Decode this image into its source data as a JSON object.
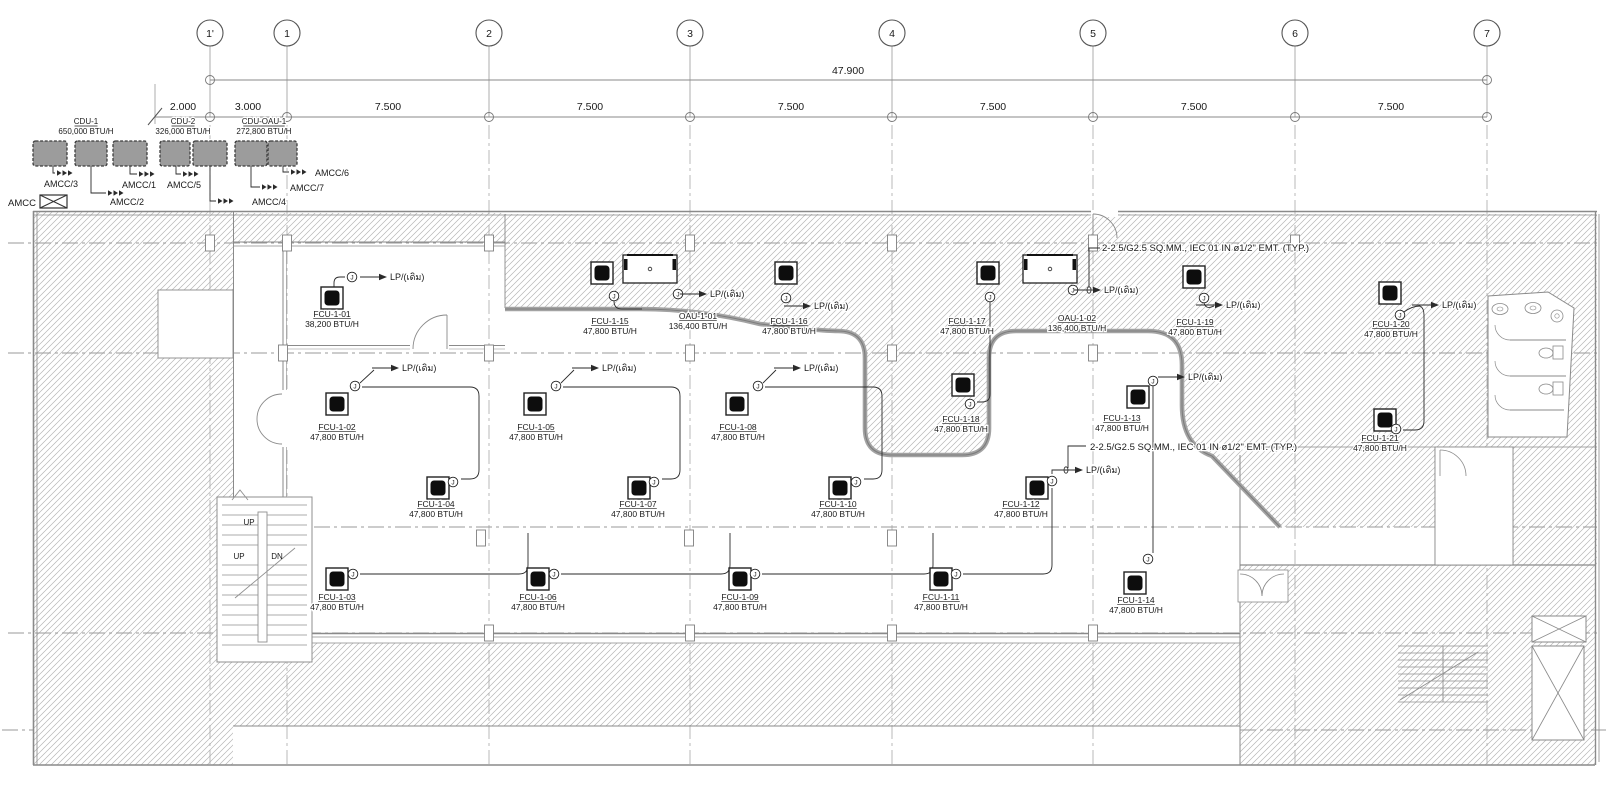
{
  "drawing_title": "FCU electrical floor plan",
  "grid": {
    "columns": [
      {
        "label": "1'",
        "x": 210
      },
      {
        "label": "1",
        "x": 287
      },
      {
        "label": "2",
        "x": 489
      },
      {
        "label": "3",
        "x": 690
      },
      {
        "label": "4",
        "x": 892
      },
      {
        "label": "5",
        "x": 1093
      },
      {
        "label": "6",
        "x": 1295
      },
      {
        "label": "7",
        "x": 1487
      }
    ],
    "overall_dim": {
      "label": "47.900",
      "x": 848,
      "y": 74
    },
    "spacing_dims": [
      {
        "label": "2.000",
        "x": 183
      },
      {
        "label": "3.000",
        "x": 248
      },
      {
        "label": "7.500",
        "x": 388
      },
      {
        "label": "7.500",
        "x": 590
      },
      {
        "label": "7.500",
        "x": 791
      },
      {
        "label": "7.500",
        "x": 993
      },
      {
        "label": "7.500",
        "x": 1194
      },
      {
        "label": "7.500",
        "x": 1391
      }
    ]
  },
  "cdu_bank": {
    "labels": [
      {
        "id": "CDU-1",
        "btu": "650,000 BTU/H",
        "x": 86
      },
      {
        "id": "CDU-2",
        "btu": "326,000 BTU/H",
        "x": 183
      },
      {
        "id": "CDU-OAU-1",
        "btu": "272,800 BTU/H",
        "x": 264
      }
    ],
    "boxes": [
      {
        "x": 33,
        "w": 34
      },
      {
        "x": 75,
        "w": 32
      },
      {
        "x": 113,
        "w": 34
      },
      {
        "x": 160,
        "w": 30
      },
      {
        "x": 193,
        "w": 34
      },
      {
        "x": 235,
        "w": 32
      },
      {
        "x": 268,
        "w": 29
      }
    ],
    "feeders": [
      {
        "label": "AMCC/3",
        "tx": 44,
        "ty": 187,
        "ax": 57,
        "ay": 173,
        "stub": "M53,166 V173 H55"
      },
      {
        "label": "AMCC/2",
        "tx": 110,
        "ty": 205,
        "ax": 108,
        "ay": 193,
        "stub": "M91,166 V193 H106"
      },
      {
        "label": "AMCC/1",
        "tx": 122,
        "ty": 188,
        "ax": 139,
        "ay": 174,
        "stub": "M130,166 V174 H137"
      },
      {
        "label": "AMCC/5",
        "tx": 167,
        "ty": 188,
        "ax": 183,
        "ay": 174,
        "stub": "M176,166 V174 H181"
      },
      {
        "label": "AMCC/4",
        "tx": 252,
        "ty": 205,
        "ax": 218,
        "ay": 201,
        "stub": "M210,166 V201 H216"
      },
      {
        "label": "AMCC/7",
        "tx": 290,
        "ty": 191,
        "ax": 262,
        "ay": 187,
        "stub": "M251,166 V187 H260"
      },
      {
        "label": "AMCC/6",
        "tx": 315,
        "ty": 176,
        "ax": 291,
        "ay": 172,
        "stub": "M283,166 V172 H289"
      }
    ],
    "legend": {
      "label": "AMCC",
      "tx": 8,
      "ty": 206,
      "bx": 40,
      "by": 195,
      "bw": 27,
      "bh": 13
    }
  },
  "units": [
    {
      "id": "FCU-1-01",
      "btu": "38,200 BTU/H",
      "type": "fcu",
      "sx": 332,
      "sy": 298,
      "lx": 332,
      "ly": 317
    },
    {
      "id": "FCU-1-15",
      "btu": "47,800 BTU/H",
      "type": "fcu",
      "sx": 602,
      "sy": 273,
      "lx": 610,
      "ly": 324
    },
    {
      "id": "OAU-1-01",
      "btu": "136,400 BTU/H",
      "type": "oau",
      "sx": 650,
      "sy": 269,
      "lx": 698,
      "ly": 319
    },
    {
      "id": "FCU-1-16",
      "btu": "47,800 BTU/H",
      "type": "fcu",
      "sx": 786,
      "sy": 273,
      "lx": 789,
      "ly": 324
    },
    {
      "id": "FCU-1-17",
      "btu": "47,800 BTU/H",
      "type": "fcu",
      "sx": 988,
      "sy": 273,
      "lx": 967,
      "ly": 324
    },
    {
      "id": "OAU-1-02",
      "btu": "136,400 BTU/H",
      "type": "oau",
      "sx": 1050,
      "sy": 269,
      "lx": 1077,
      "ly": 321
    },
    {
      "id": "FCU-1-19",
      "btu": "47,800 BTU/H",
      "type": "fcu",
      "sx": 1194,
      "sy": 277,
      "lx": 1195,
      "ly": 325
    },
    {
      "id": "FCU-1-20",
      "btu": "47,800 BTU/H",
      "type": "fcu",
      "sx": 1390,
      "sy": 293,
      "lx": 1391,
      "ly": 327
    },
    {
      "id": "FCU-1-02",
      "btu": "47,800 BTU/H",
      "type": "fcu",
      "sx": 337,
      "sy": 404,
      "lx": 337,
      "ly": 430
    },
    {
      "id": "FCU-1-05",
      "btu": "47,800 BTU/H",
      "type": "fcu",
      "sx": 535,
      "sy": 404,
      "lx": 536,
      "ly": 430
    },
    {
      "id": "FCU-1-08",
      "btu": "47,800 BTU/H",
      "type": "fcu",
      "sx": 737,
      "sy": 404,
      "lx": 738,
      "ly": 430
    },
    {
      "id": "FCU-1-18",
      "btu": "47,800 BTU/H",
      "type": "fcu",
      "sx": 963,
      "sy": 385,
      "lx": 961,
      "ly": 422
    },
    {
      "id": "FCU-1-13",
      "btu": "47,800 BTU/H",
      "type": "fcu",
      "sx": 1138,
      "sy": 397,
      "lx": 1122,
      "ly": 421
    },
    {
      "id": "FCU-1-21",
      "btu": "47,800 BTU/H",
      "type": "fcu",
      "sx": 1385,
      "sy": 420,
      "lx": 1380,
      "ly": 441
    },
    {
      "id": "FCU-1-04",
      "btu": "47,800 BTU/H",
      "type": "fcu",
      "sx": 438,
      "sy": 488,
      "lx": 436,
      "ly": 507
    },
    {
      "id": "FCU-1-07",
      "btu": "47,800 BTU/H",
      "type": "fcu",
      "sx": 639,
      "sy": 488,
      "lx": 638,
      "ly": 507
    },
    {
      "id": "FCU-1-10",
      "btu": "47,800 BTU/H",
      "type": "fcu",
      "sx": 840,
      "sy": 488,
      "lx": 838,
      "ly": 507
    },
    {
      "id": "FCU-1-12",
      "btu": "47,800 BTU/H",
      "type": "fcu",
      "sx": 1037,
      "sy": 488,
      "lx": 1021,
      "ly": 507
    },
    {
      "id": "FCU-1-03",
      "btu": "47,800 BTU/H",
      "type": "fcu",
      "sx": 337,
      "sy": 579,
      "lx": 337,
      "ly": 600
    },
    {
      "id": "FCU-1-06",
      "btu": "47,800 BTU/H",
      "type": "fcu",
      "sx": 538,
      "sy": 579,
      "lx": 538,
      "ly": 600
    },
    {
      "id": "FCU-1-09",
      "btu": "47,800 BTU/H",
      "type": "fcu",
      "sx": 740,
      "sy": 579,
      "lx": 740,
      "ly": 600
    },
    {
      "id": "FCU-1-11",
      "btu": "47,800 BTU/H",
      "type": "fcu",
      "sx": 941,
      "sy": 579,
      "lx": 941,
      "ly": 600
    },
    {
      "id": "FCU-1-14",
      "btu": "47,800 BTU/H",
      "type": "fcu",
      "sx": 1135,
      "sy": 583,
      "lx": 1136,
      "ly": 603
    }
  ],
  "junction_boxes": {
    "glyph": "J",
    "points": [
      {
        "x": 352,
        "y": 277
      },
      {
        "x": 614,
        "y": 296
      },
      {
        "x": 678,
        "y": 294
      },
      {
        "x": 786,
        "y": 298
      },
      {
        "x": 990,
        "y": 297
      },
      {
        "x": 1073,
        "y": 290
      },
      {
        "x": 1204,
        "y": 298
      },
      {
        "x": 1400,
        "y": 315
      },
      {
        "x": 970,
        "y": 404
      },
      {
        "x": 1396,
        "y": 429
      },
      {
        "x": 355,
        "y": 386
      },
      {
        "x": 556,
        "y": 386
      },
      {
        "x": 758,
        "y": 386
      },
      {
        "x": 1153,
        "y": 381
      },
      {
        "x": 453,
        "y": 482
      },
      {
        "x": 654,
        "y": 482
      },
      {
        "x": 856,
        "y": 482
      },
      {
        "x": 1052,
        "y": 481
      },
      {
        "x": 353,
        "y": 574
      },
      {
        "x": 554,
        "y": 574
      },
      {
        "x": 755,
        "y": 574
      },
      {
        "x": 956,
        "y": 574
      },
      {
        "x": 1148,
        "y": 559
      }
    ]
  },
  "lp_labels": {
    "text": "LP/(เดิม)",
    "points": [
      {
        "x": 392,
        "y": 280
      },
      {
        "x": 712,
        "y": 297
      },
      {
        "x": 816,
        "y": 309
      },
      {
        "x": 1106,
        "y": 293
      },
      {
        "x": 1228,
        "y": 308
      },
      {
        "x": 1444,
        "y": 308
      },
      {
        "x": 404,
        "y": 371
      },
      {
        "x": 604,
        "y": 371
      },
      {
        "x": 806,
        "y": 371
      },
      {
        "x": 1190,
        "y": 380
      },
      {
        "x": 1088,
        "y": 473
      }
    ]
  },
  "notes": [
    {
      "text": "2-2.5/G2.5 SQ.MM., IEC 01 IN ø1/2\" EMT. (TYP.)",
      "x": 1102,
      "y": 251
    },
    {
      "text": "2-2.5/G2.5 SQ.MM., IEC 01 IN ø1/2\" EMT. (TYP.)",
      "x": 1090,
      "y": 450
    }
  ],
  "stair_labels": [
    {
      "text": "UP",
      "x": 239,
      "y": 559
    },
    {
      "text": "DN",
      "x": 277,
      "y": 559
    },
    {
      "text": "UP",
      "x": 249,
      "y": 525
    }
  ],
  "colors": {
    "hatch_line": "#b5b5b5",
    "wall": "#8a8a8a",
    "band": "#a3a3a3",
    "wire": "#2a2a2a",
    "ink": "#1a1a1a",
    "cdu_fill": "#9c9c9c"
  }
}
